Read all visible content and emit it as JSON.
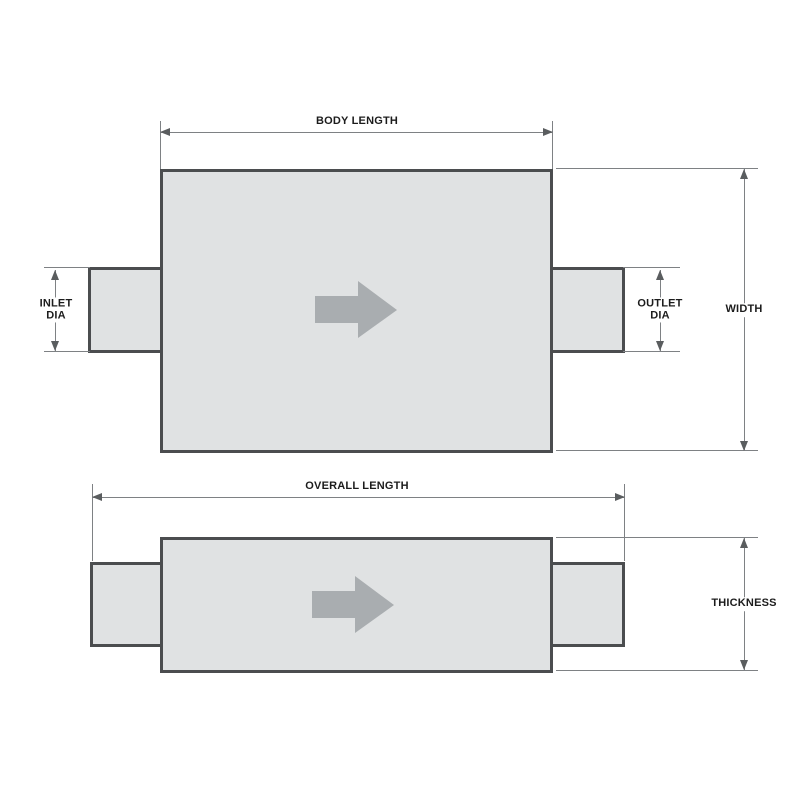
{
  "page": {
    "background": "#ffffff"
  },
  "colors": {
    "part_fill": "#e0e2e3",
    "part_border": "#4b4d4f",
    "dimension_line": "#7e8184",
    "arrowhead": "#5a5d5f",
    "flow_arrow": "#a9adb0",
    "label_text": "#1c1c1c"
  },
  "top_view": {
    "labels": {
      "body_length": "BODY LENGTH",
      "inlet_dia_line1": "INLET",
      "inlet_dia_line2": "DIA",
      "outlet_dia_line1": "OUTLET",
      "outlet_dia_line2": "DIA",
      "width": "WIDTH"
    }
  },
  "side_view": {
    "labels": {
      "overall_length": "OVERALL LENGTH",
      "thickness": "THICKNESS"
    }
  }
}
